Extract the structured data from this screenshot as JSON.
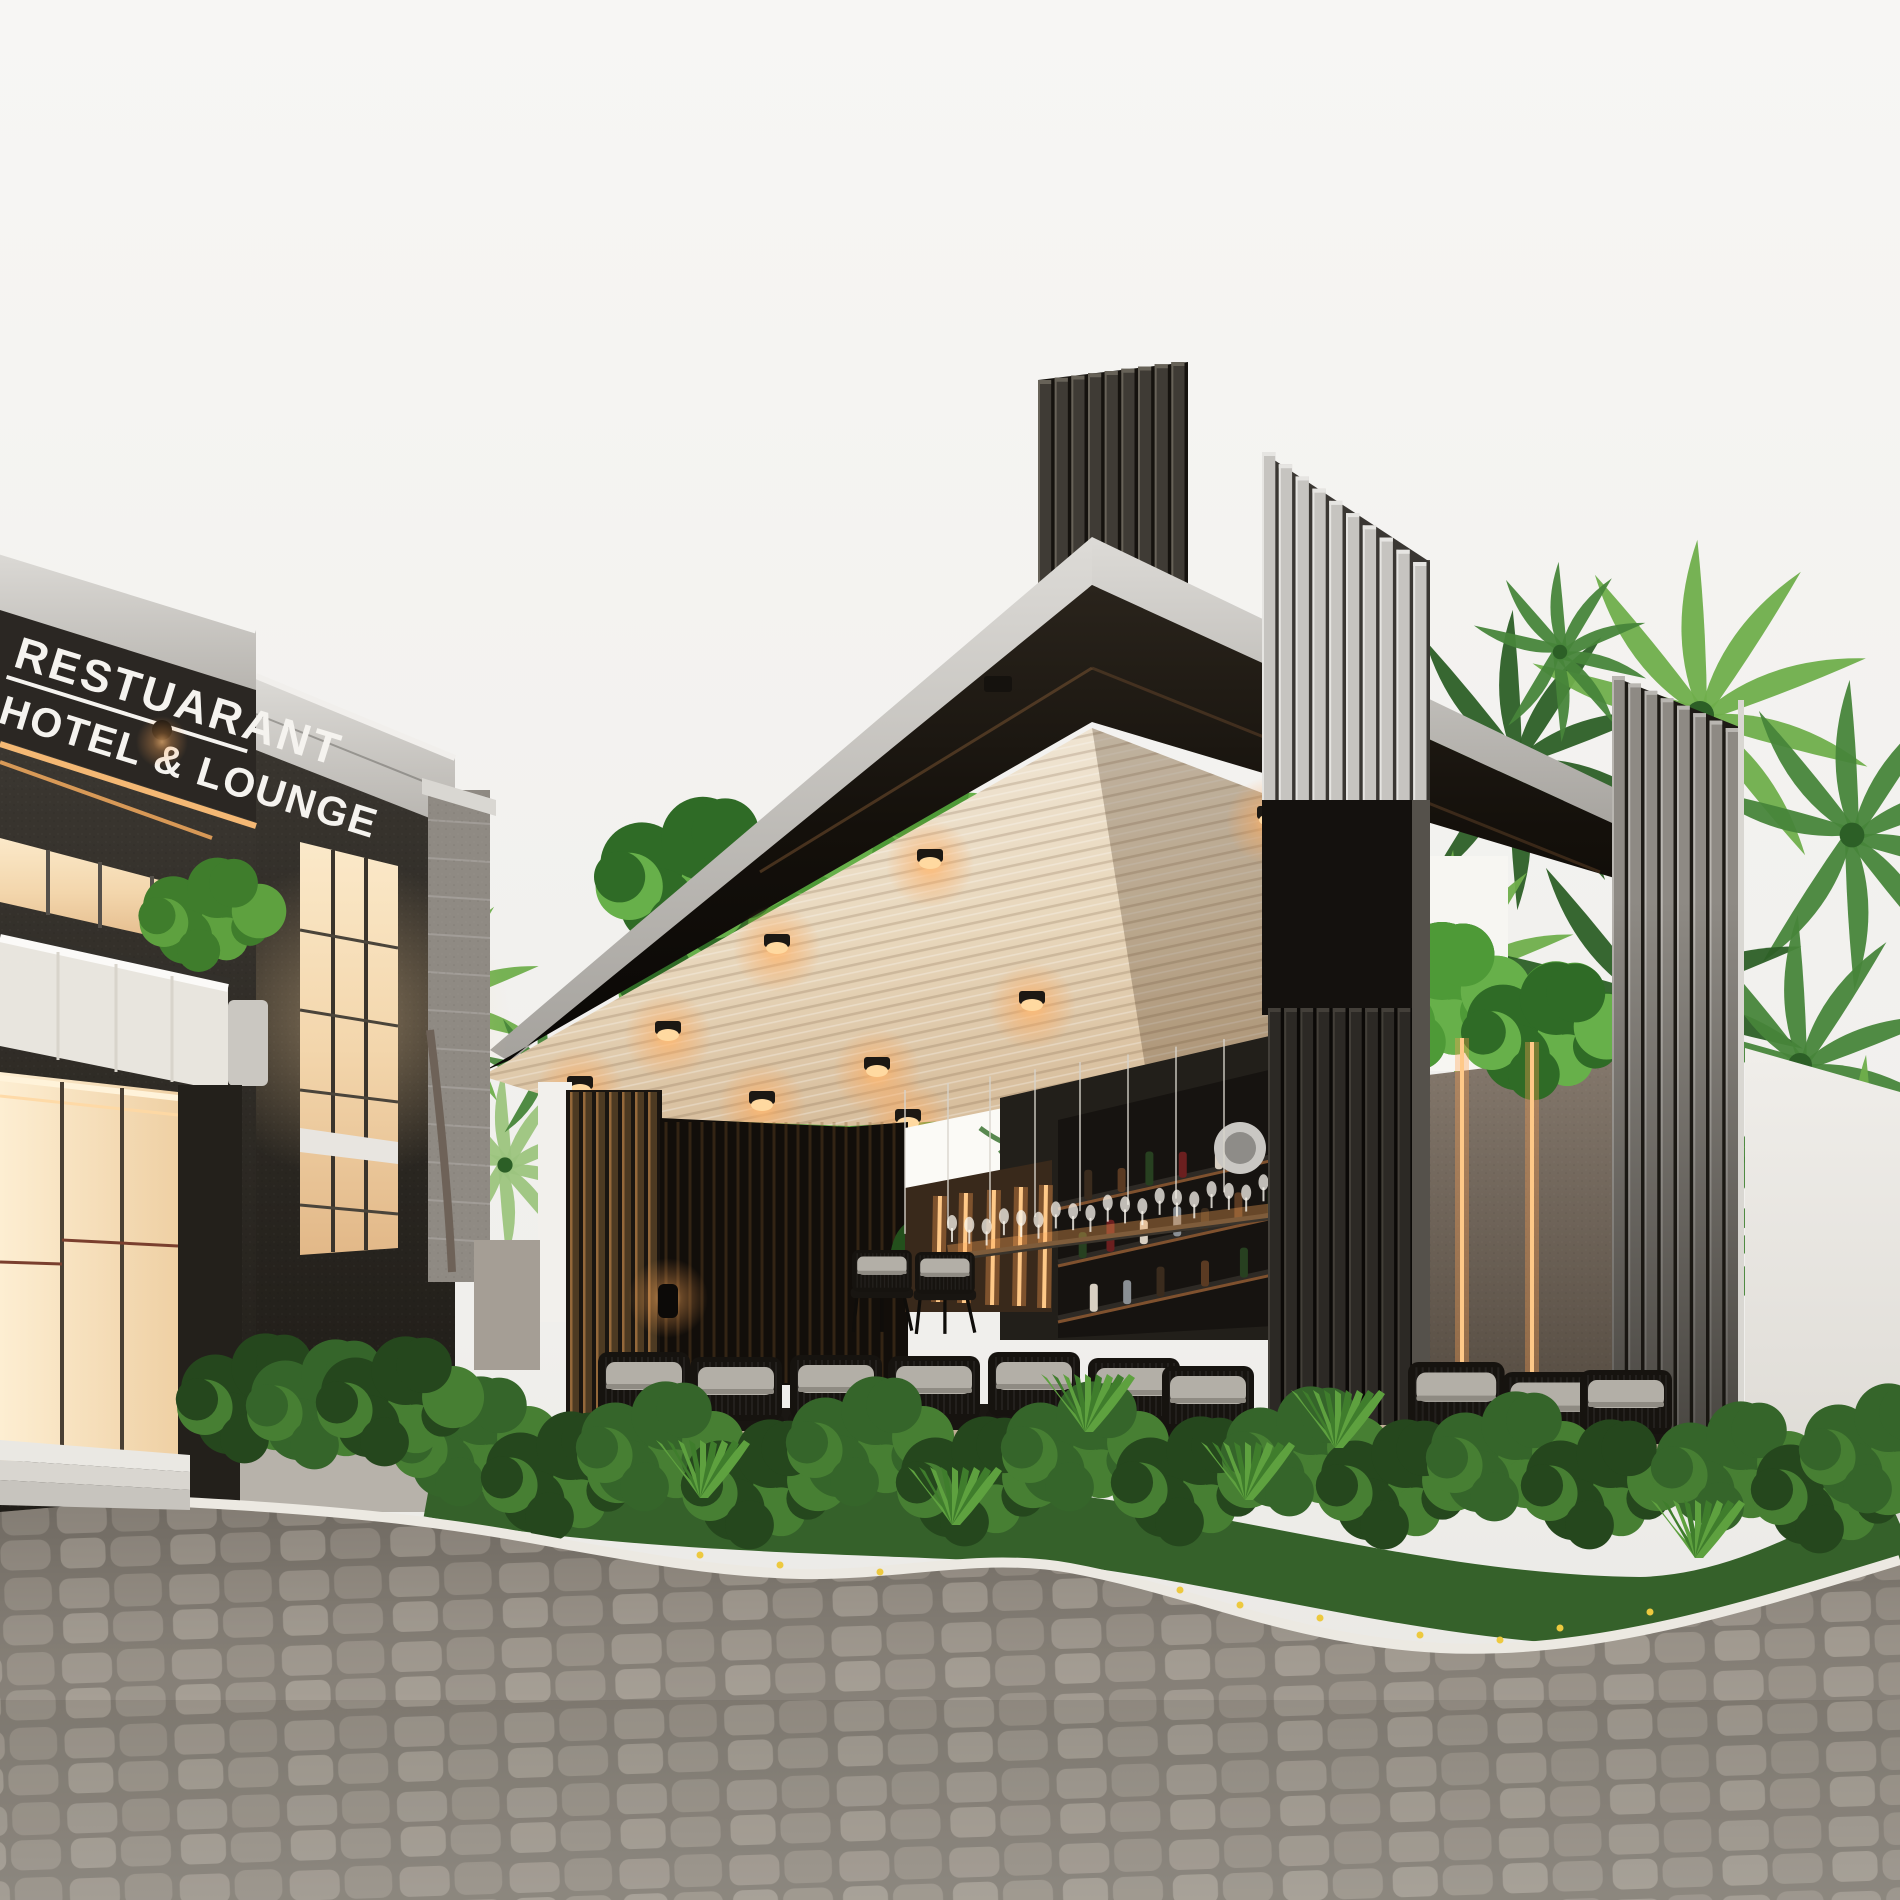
{
  "sign": {
    "line1": "RESTUARANT",
    "line2": "HOTEL & LOUNGE"
  },
  "palette": {
    "sky": "#f5f4f2",
    "facade_dark": "#35312b",
    "parapet": "#d3d1cc",
    "window_glow": "#f6ddb7",
    "canopy_top": "#cfcdc9",
    "fascia": "#16120d",
    "ceiling": "#ecdfc9",
    "accent_warm": "#ffaa5e",
    "foliage": "#4e9a37",
    "cobble": "#a29b92",
    "white_wall": "#eceae5"
  },
  "ceiling_lights": [
    [
      777,
      943
    ],
    [
      930,
      858
    ],
    [
      1032,
      1000
    ],
    [
      877,
      1066
    ],
    [
      668,
      1030
    ],
    [
      580,
      1085
    ],
    [
      762,
      1100
    ],
    [
      908,
      1118
    ],
    [
      1270,
      815
    ]
  ],
  "wall_strips": [
    [
      1462,
      1038,
      1462,
      1462
    ],
    [
      1532,
      1042,
      1532,
      1468
    ],
    [
      940,
      1196,
      938,
      1302
    ],
    [
      966,
      1193,
      964,
      1303
    ],
    [
      994,
      1190,
      992,
      1305
    ],
    [
      1021,
      1187,
      1019,
      1306
    ],
    [
      1046,
      1185,
      1044,
      1308
    ]
  ],
  "chairs": [
    [
      598,
      1352,
      1
    ],
    [
      690,
      1357,
      1
    ],
    [
      790,
      1355,
      1
    ],
    [
      888,
      1356,
      1
    ],
    [
      988,
      1352,
      1
    ],
    [
      1088,
      1358,
      1
    ],
    [
      1162,
      1366,
      1
    ],
    [
      1408,
      1362,
      1.05
    ],
    [
      1502,
      1372,
      1.05
    ],
    [
      1580,
      1370,
      1
    ],
    [
      852,
      1250,
      0.65
    ],
    [
      915,
      1252,
      0.65
    ]
  ],
  "tables": [
    [
      712,
      1408,
      85
    ],
    [
      930,
      1404,
      120
    ],
    [
      1464,
      1412,
      115
    ]
  ],
  "palms": [
    [
      1515,
      760,
      150,
      "dark"
    ],
    [
      1700,
      715,
      175,
      "bright"
    ],
    [
      1852,
      835,
      155,
      "mid"
    ],
    [
      1455,
      975,
      125,
      "bright"
    ],
    [
      1645,
      1000,
      165,
      "dark"
    ],
    [
      1800,
      1065,
      150,
      "mid"
    ],
    [
      1520,
      1185,
      135,
      "dark"
    ],
    [
      1705,
      1235,
      140,
      "mid"
    ],
    [
      1868,
      1185,
      130,
      "bright"
    ],
    [
      1560,
      652,
      90,
      "mid"
    ],
    [
      425,
      1005,
      120,
      "bright"
    ],
    [
      505,
      1165,
      95,
      "pale"
    ],
    [
      545,
      1075,
      70,
      "mid"
    ]
  ],
  "tree_blobs": [
    [
      760,
      980,
      120
    ],
    [
      880,
      930,
      110
    ],
    [
      980,
      1000,
      100
    ],
    [
      840,
      1090,
      110
    ],
    [
      720,
      1120,
      90
    ],
    [
      950,
      1110,
      90
    ],
    [
      690,
      880,
      80
    ],
    [
      900,
      840,
      80
    ],
    [
      1330,
      1030,
      80
    ],
    [
      1430,
      1000,
      75
    ],
    [
      1545,
      1035,
      70
    ],
    [
      1255,
      1065,
      60
    ]
  ],
  "bushes": [
    [
      470,
      1445
    ],
    [
      560,
      1480
    ],
    [
      655,
      1450
    ],
    [
      760,
      1488
    ],
    [
      865,
      1445
    ],
    [
      975,
      1485
    ],
    [
      1080,
      1450
    ],
    [
      1190,
      1485
    ],
    [
      1300,
      1455
    ],
    [
      1395,
      1488
    ],
    [
      1505,
      1460
    ],
    [
      1600,
      1488
    ],
    [
      1730,
      1470
    ],
    [
      1830,
      1492
    ],
    [
      1878,
      1452
    ],
    [
      255,
      1402
    ],
    [
      325,
      1408
    ],
    [
      395,
      1405
    ]
  ],
  "yuccas": [
    [
      700,
      1498
    ],
    [
      952,
      1525
    ],
    [
      1085,
      1432
    ],
    [
      1245,
      1500
    ],
    [
      1335,
      1448
    ],
    [
      1695,
      1558
    ]
  ],
  "flowers": [
    [
      1180,
      1590
    ],
    [
      1240,
      1605
    ],
    [
      1320,
      1618
    ],
    [
      1420,
      1635
    ],
    [
      1500,
      1640
    ],
    [
      1560,
      1628
    ],
    [
      780,
      1565
    ],
    [
      700,
      1555
    ],
    [
      880,
      1572
    ],
    [
      1650,
      1612
    ]
  ],
  "towers": [
    {
      "x": 1038,
      "w": 150,
      "top1": 380,
      "top2": 362,
      "bottom": 588,
      "n": 9,
      "bg": "#15120e",
      "face": "#3f3b35",
      "edge": "#676258"
    },
    {
      "x": 1262,
      "w": 168,
      "top1": 452,
      "top2": 562,
      "bottom": 800,
      "n": 10,
      "bg": "#3a3733",
      "face": "#c6c4c0",
      "edge": "#e6e5e2"
    },
    {
      "x": 1268,
      "w": 162,
      "top1": 1008,
      "top2": 1008,
      "bottom": 1478,
      "n": 10,
      "bg": "#0b0907",
      "face": "#2c2925",
      "edge": "#433f39"
    },
    {
      "x": 1612,
      "w": 130,
      "top1": 676,
      "top2": 728,
      "bottom": 1478,
      "n": 8,
      "bg": "#1d1a15",
      "face": "#8e8a84",
      "edge": "#b9b6b1"
    }
  ],
  "bottles": [
    [
      0,
      0.08,
      30
    ],
    [
      0,
      0.2,
      24
    ],
    [
      0,
      0.3,
      34
    ],
    [
      0,
      0.42,
      26
    ],
    [
      0,
      0.55,
      30
    ],
    [
      0,
      0.66,
      22
    ],
    [
      0,
      0.78,
      30
    ],
    [
      0,
      0.9,
      26
    ],
    [
      1,
      0.06,
      26
    ],
    [
      1,
      0.16,
      32
    ],
    [
      1,
      0.28,
      24
    ],
    [
      1,
      0.4,
      30
    ],
    [
      1,
      0.5,
      22
    ],
    [
      1,
      0.62,
      30
    ],
    [
      1,
      0.74,
      26
    ],
    [
      1,
      0.86,
      32
    ],
    [
      2,
      0.1,
      28
    ],
    [
      2,
      0.22,
      24
    ],
    [
      2,
      0.34,
      30
    ],
    [
      2,
      0.5,
      26
    ],
    [
      2,
      0.64,
      30
    ],
    [
      2,
      0.78,
      24
    ],
    [
      2,
      0.9,
      28
    ]
  ],
  "glass_count": 24
}
